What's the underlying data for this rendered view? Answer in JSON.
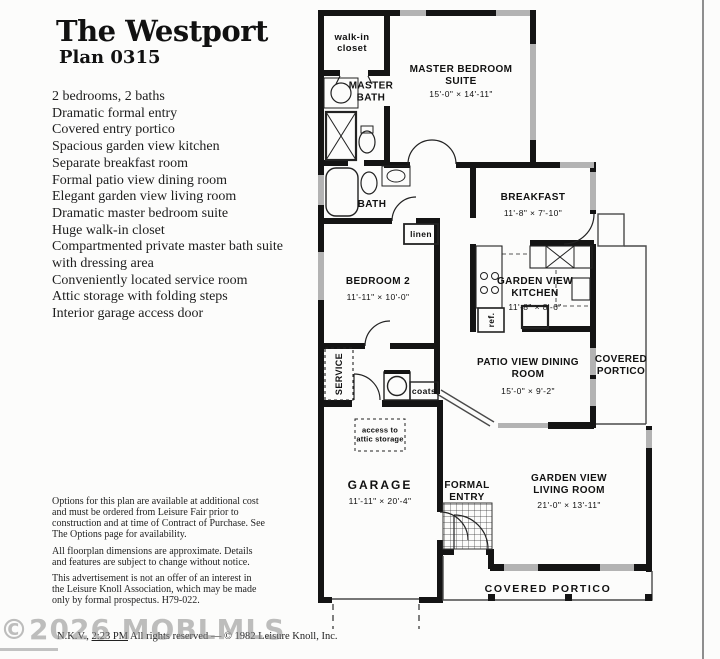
{
  "page": {
    "title": "The Westport",
    "plan_number": "Plan 0315",
    "features": [
      "2 bedrooms, 2 baths",
      "Dramatic formal entry",
      "Covered entry portico",
      "Spacious garden view kitchen",
      "Separate breakfast room",
      "Formal patio view dining room",
      "Elegant garden view living room",
      "Dramatic master bedroom suite",
      "Huge walk-in closet",
      "Compartmented private master bath suite with dressing area",
      "Conveniently located service room",
      "Attic storage with folding steps",
      "Interior garage access door"
    ],
    "disclaimers": [
      "Options for this plan are available at additional cost and must be ordered from Leisure Fair prior to construction and at time of Contract of Purchase. See The Options page for availability.",
      "All floorplan dimensions are approximate. Details and features are subject to change without notice.",
      "This advertisement is not an offer of an interest in the Leisure Knoll Association, which may be made only by formal prospectus. H79-022."
    ],
    "watermark": "©2026 MOBLMLS",
    "copyright": {
      "prefix": "N.K.V., ",
      "time": "2:23 PM",
      "suffix": " All rights reserved — © 1982 Leisure Knoll, Inc."
    }
  },
  "floorplan": {
    "rooms": {
      "walkin_closet": {
        "label": "walk-in closet"
      },
      "master_bath": {
        "label": "MASTER BATH"
      },
      "master_bedroom": {
        "label": "MASTER BEDROOM SUITE",
        "dims": "15'-0\" × 14'-11\""
      },
      "bath": {
        "label": "BATH"
      },
      "linen": {
        "label": "linen"
      },
      "breakfast": {
        "label": "BREAKFAST",
        "dims": "11'-8\" × 7'-10\""
      },
      "bedroom2": {
        "label": "BEDROOM 2",
        "dims": "11'-11\" × 10'-0\""
      },
      "kitchen": {
        "label": "GARDEN VIEW KITCHEN",
        "dims": "11'-8\" × 8'-6\""
      },
      "refrigerator": {
        "label": "ref."
      },
      "service": {
        "label": "SERVICE"
      },
      "coats": {
        "label": "coats"
      },
      "dining": {
        "label": "PATIO VIEW DINING ROOM",
        "dims": "15'-0\" × 9'-2\""
      },
      "portico_side": {
        "label": "COVERED PORTICO"
      },
      "attic_access": {
        "label": "access to attic storage"
      },
      "garage": {
        "label": "GARAGE",
        "dims": "11'-11\" × 20'-4\""
      },
      "formal_entry": {
        "label": "FORMAL ENTRY"
      },
      "living": {
        "label": "GARDEN VIEW LIVING ROOM",
        "dims": "21'-0\" × 13'-11\""
      },
      "portico_bottom": {
        "label": "COVERED PORTICO"
      }
    }
  }
}
